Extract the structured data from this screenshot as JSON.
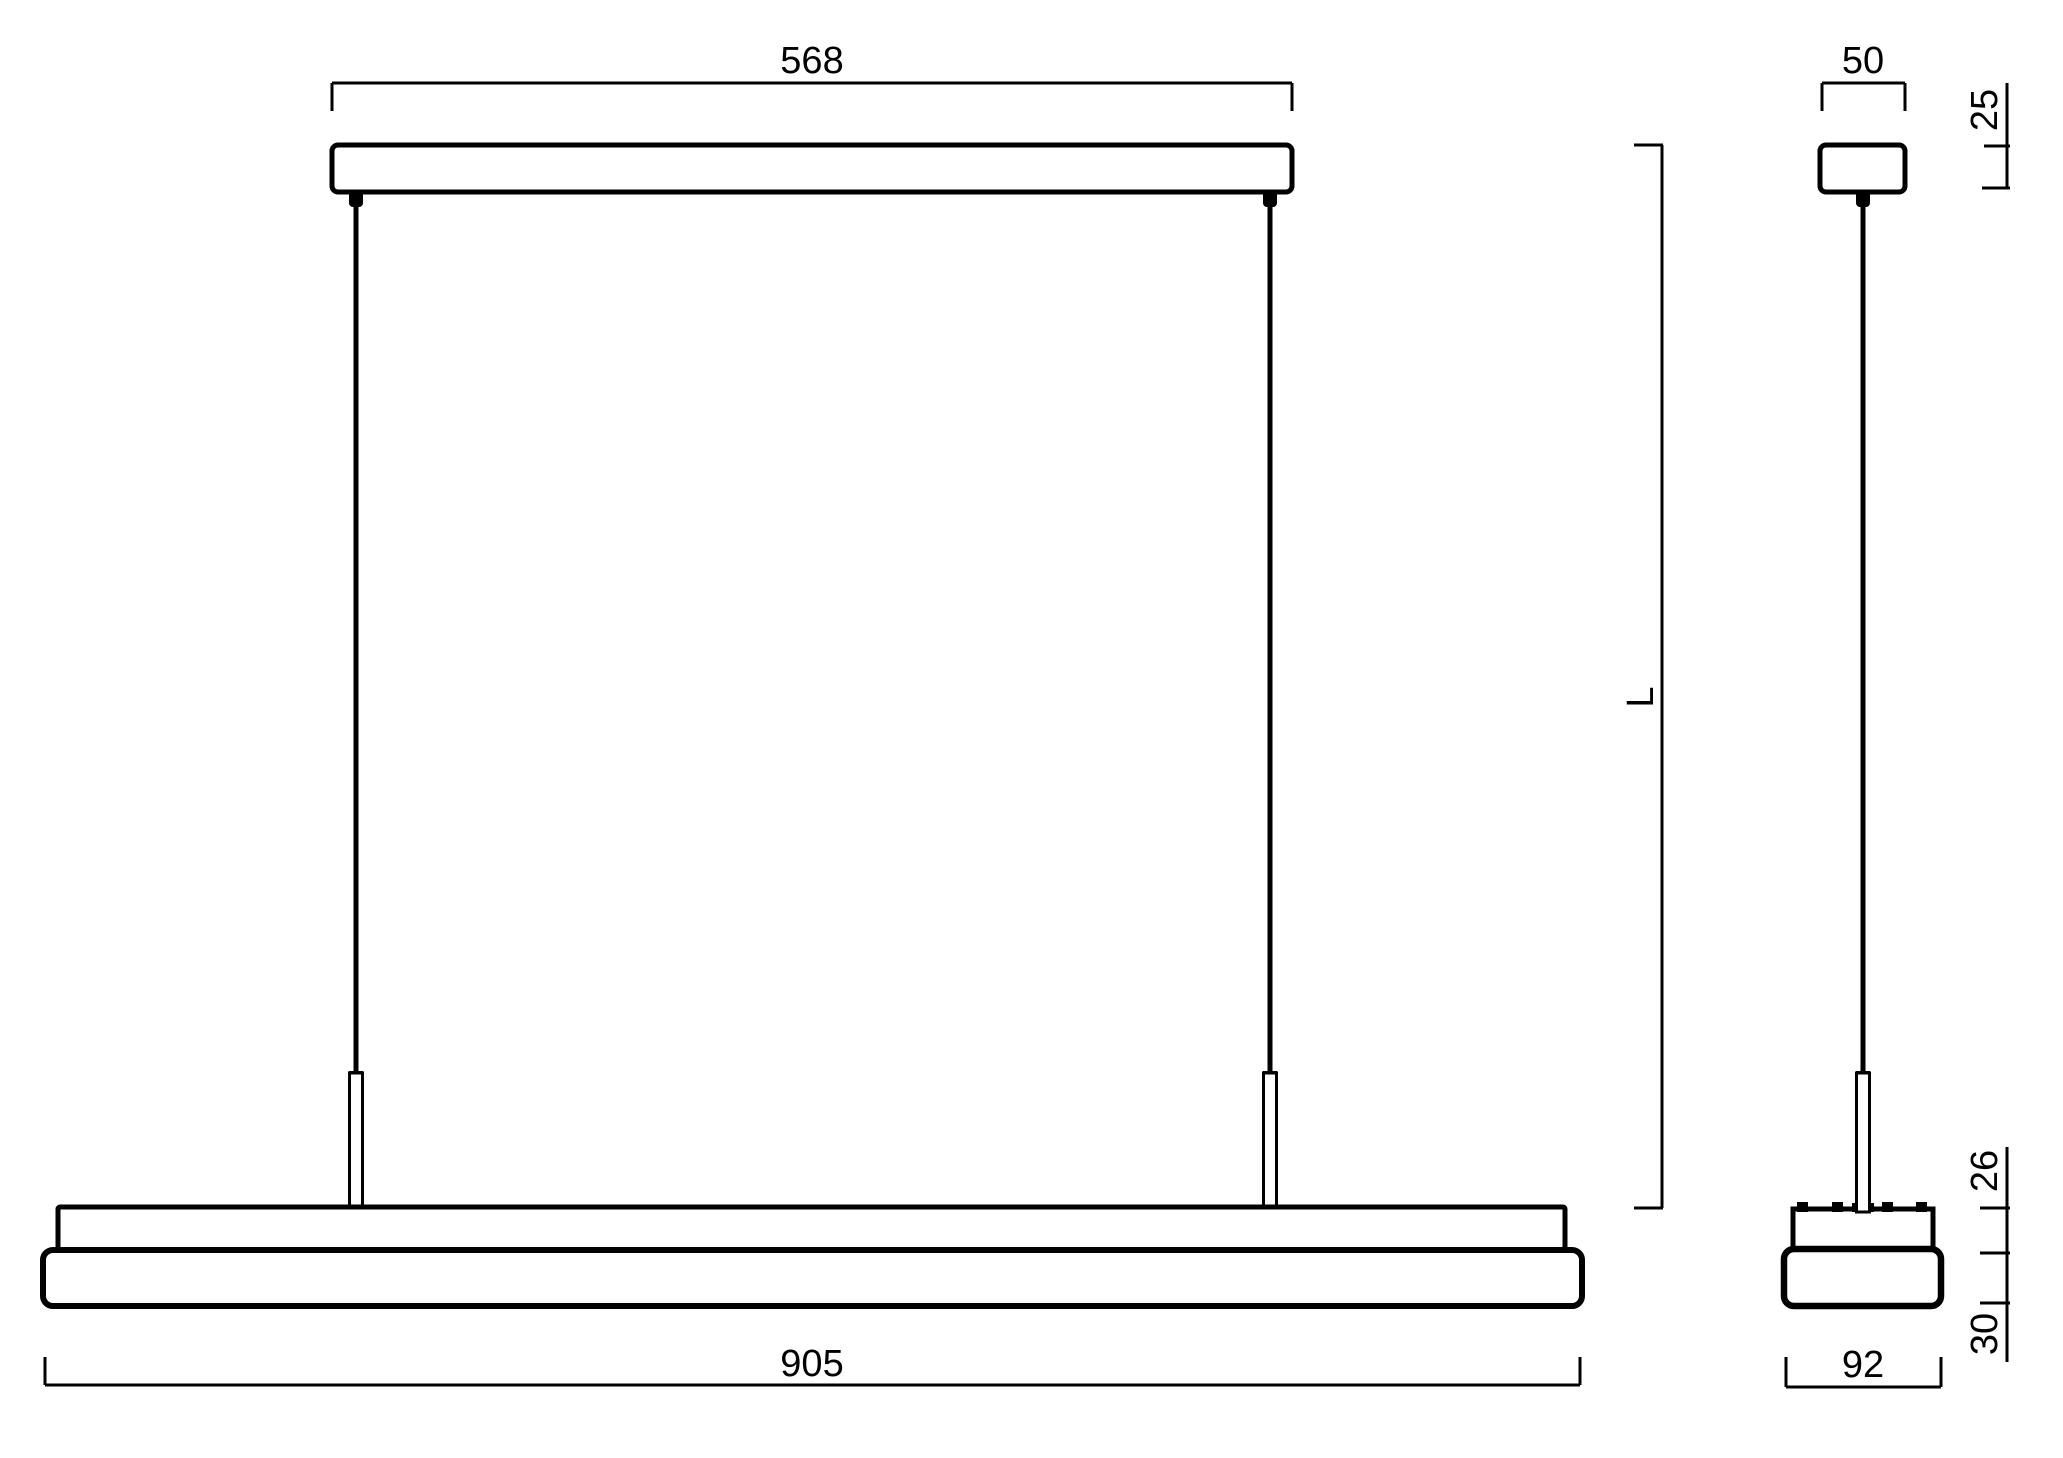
{
  "page": {
    "background": "#ffffff",
    "line_color": "#000000",
    "kind": "technical dimension drawing of a linear pendant luminaire"
  },
  "front_view": {
    "label": "front view",
    "dim_canopy_width": "568",
    "dim_body_length": "905",
    "dim_pendant_length": "L"
  },
  "side_view": {
    "label": "side view",
    "dim_canopy_width": "50",
    "dim_canopy_height": "25",
    "dim_body_width": "92",
    "dim_body_upper_height": "26",
    "dim_body_lower_height": "30"
  }
}
